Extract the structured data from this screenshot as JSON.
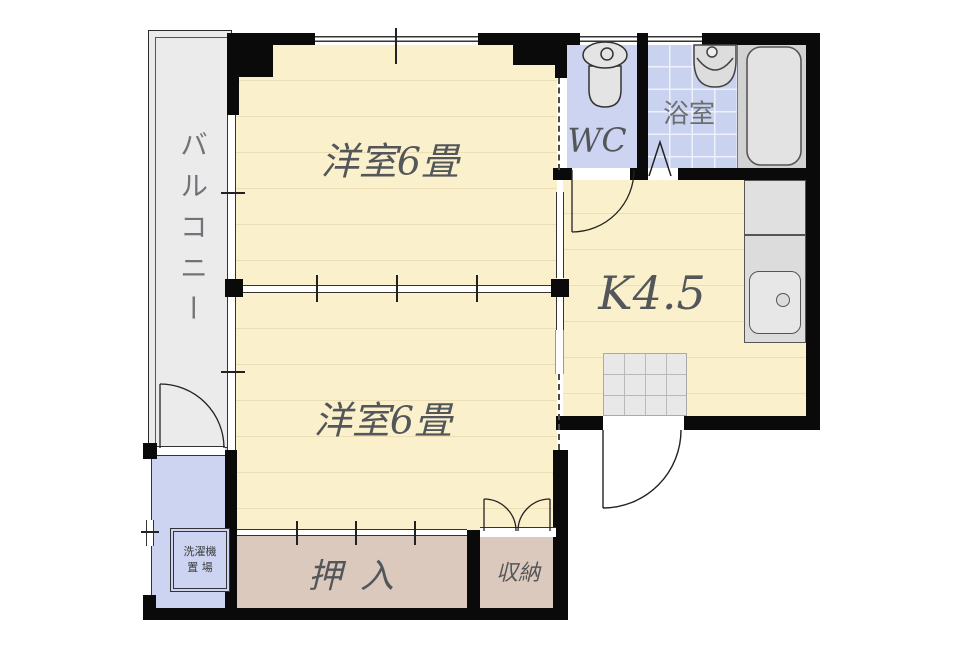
{
  "rooms": {
    "balcony": "バルコニー",
    "western_room_top": "洋室6畳",
    "western_room_bottom": "洋室6畳",
    "kitchen": "K4.5",
    "wc": "WC",
    "bathroom": "浴室",
    "closet": "押入",
    "storage": "収納",
    "laundry_line1": "洗濯機",
    "laundry_line2": "置 場"
  },
  "colors": {
    "room_floor": "#faf0cb",
    "floor_line": "#ecdfb6",
    "wet_area": "#ccd4f1",
    "bath_tile": "#c9d2ee",
    "closet_floor": "#dcc9be",
    "balcony_floor": "#ebebeb",
    "counter_gray": "#dcdcdc",
    "wall": "#0a0a0a",
    "label_text": "#54575a"
  }
}
